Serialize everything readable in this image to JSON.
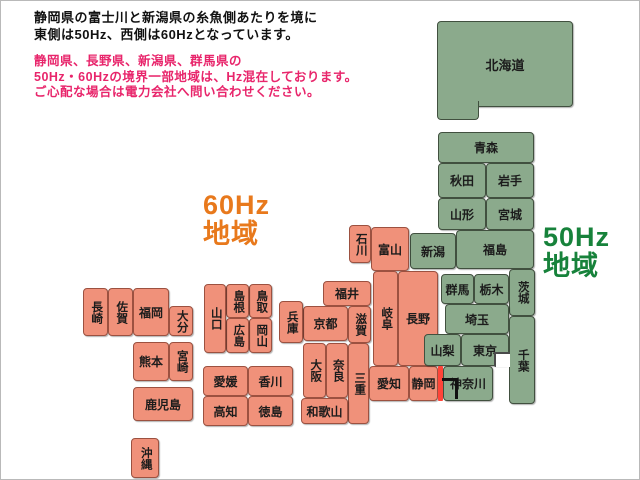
{
  "header": {
    "line1": "静岡県の富士川と新潟県の糸魚側あたりを境に",
    "line2": "東側は50Hz、西側は60Hzとなっています。",
    "text_color": "#111111",
    "notice_line1": "静岡県、長野県、新潟県、群馬県の",
    "notice_line2": "50Hz・60Hzの境界一部地域は、Hz混在しております。",
    "notice_line3": "ご心配な場合は電力会社へ問い合わせください。",
    "notice_color": "#e8256b"
  },
  "legend": {
    "west": {
      "freq": "60Hz",
      "area": "地域",
      "color": "#e8791c"
    },
    "east": {
      "freq": "50Hz",
      "area": "地域",
      "color": "#17823b"
    }
  },
  "map": {
    "colors": {
      "hz50_fill": "#8baa8c",
      "hz50_border": "#41503f",
      "hz60_fill": "#f0917a",
      "hz60_border": "#9c5140",
      "outline": "#4a4a4a",
      "boundary_red": "#ff4438",
      "boundary_black": "#111111"
    },
    "prefectures": [
      {
        "id": "hokkaido",
        "label": "北海道",
        "region": "50",
        "x": 436,
        "y": 20,
        "w": 136,
        "h": 86,
        "orient": "h",
        "cls": "big"
      },
      {
        "id": "hokkaido-leg",
        "label": "",
        "region": "50",
        "x": 436,
        "y": 100,
        "w": 42,
        "h": 19,
        "orient": "h",
        "cls": "noTop"
      },
      {
        "id": "aomori",
        "label": "青森",
        "region": "50",
        "x": 437,
        "y": 131,
        "w": 96,
        "h": 31,
        "orient": "h"
      },
      {
        "id": "akita",
        "label": "秋田",
        "region": "50",
        "x": 437,
        "y": 162,
        "w": 48,
        "h": 35,
        "orient": "h"
      },
      {
        "id": "iwate",
        "label": "岩手",
        "region": "50",
        "x": 485,
        "y": 162,
        "w": 48,
        "h": 35,
        "orient": "h"
      },
      {
        "id": "yamagata",
        "label": "山形",
        "region": "50",
        "x": 437,
        "y": 197,
        "w": 48,
        "h": 32,
        "orient": "h"
      },
      {
        "id": "miyagi",
        "label": "宮城",
        "region": "50",
        "x": 485,
        "y": 197,
        "w": 48,
        "h": 32,
        "orient": "h"
      },
      {
        "id": "niigata",
        "label": "新潟",
        "region": "50",
        "x": 409,
        "y": 232,
        "w": 46,
        "h": 36,
        "orient": "h"
      },
      {
        "id": "fukushima",
        "label": "福島",
        "region": "50",
        "x": 455,
        "y": 229,
        "w": 78,
        "h": 39,
        "orient": "h"
      },
      {
        "id": "ishikawa",
        "label": "石川",
        "region": "60",
        "x": 348,
        "y": 224,
        "w": 22,
        "h": 38,
        "orient": "v"
      },
      {
        "id": "toyama",
        "label": "富山",
        "region": "60",
        "x": 370,
        "y": 226,
        "w": 38,
        "h": 44,
        "orient": "h"
      },
      {
        "id": "gifu",
        "label": "岐阜",
        "region": "60",
        "x": 372,
        "y": 270,
        "w": 25,
        "h": 95,
        "orient": "v"
      },
      {
        "id": "nagano",
        "label": "長野",
        "region": "60",
        "x": 397,
        "y": 270,
        "w": 40,
        "h": 95,
        "orient": "h"
      },
      {
        "id": "fukui",
        "label": "福井",
        "region": "60",
        "x": 322,
        "y": 280,
        "w": 48,
        "h": 25,
        "orient": "h"
      },
      {
        "id": "kyoto",
        "label": "京都",
        "region": "60",
        "x": 302,
        "y": 305,
        "w": 45,
        "h": 35,
        "orient": "h"
      },
      {
        "id": "shiga",
        "label": "滋賀",
        "region": "60",
        "x": 347,
        "y": 305,
        "w": 23,
        "h": 37,
        "orient": "v"
      },
      {
        "id": "hyogo",
        "label": "兵庫",
        "region": "60",
        "x": 278,
        "y": 300,
        "w": 24,
        "h": 42,
        "orient": "v"
      },
      {
        "id": "osaka",
        "label": "大阪",
        "region": "60",
        "x": 302,
        "y": 342,
        "w": 23,
        "h": 55,
        "orient": "v"
      },
      {
        "id": "nara",
        "label": "奈良",
        "region": "60",
        "x": 325,
        "y": 342,
        "w": 22,
        "h": 55,
        "orient": "v"
      },
      {
        "id": "mie",
        "label": "三重",
        "region": "60",
        "x": 347,
        "y": 342,
        "w": 21,
        "h": 81,
        "orient": "v"
      },
      {
        "id": "wakayama",
        "label": "和歌山",
        "region": "60",
        "x": 300,
        "y": 397,
        "w": 47,
        "h": 26,
        "orient": "h"
      },
      {
        "id": "aichi",
        "label": "愛知",
        "region": "60",
        "x": 368,
        "y": 365,
        "w": 40,
        "h": 35,
        "orient": "h"
      },
      {
        "id": "shizuoka",
        "label": "静岡",
        "region": "60",
        "x": 408,
        "y": 365,
        "w": 29,
        "h": 35,
        "orient": "h"
      },
      {
        "id": "tottori",
        "label": "鳥取",
        "region": "60",
        "x": 248,
        "y": 283,
        "w": 23,
        "h": 34,
        "orient": "v"
      },
      {
        "id": "shimane",
        "label": "島根",
        "region": "60",
        "x": 225,
        "y": 283,
        "w": 23,
        "h": 34,
        "orient": "v"
      },
      {
        "id": "okayama",
        "label": "岡山",
        "region": "60",
        "x": 248,
        "y": 317,
        "w": 23,
        "h": 35,
        "orient": "v"
      },
      {
        "id": "hiroshima",
        "label": "広島",
        "region": "60",
        "x": 225,
        "y": 317,
        "w": 23,
        "h": 35,
        "orient": "v"
      },
      {
        "id": "yamaguchi",
        "label": "山口",
        "region": "60",
        "x": 203,
        "y": 283,
        "w": 22,
        "h": 69,
        "orient": "v"
      },
      {
        "id": "ehime",
        "label": "愛媛",
        "region": "60",
        "x": 202,
        "y": 365,
        "w": 45,
        "h": 30,
        "orient": "h"
      },
      {
        "id": "kagawa",
        "label": "香川",
        "region": "60",
        "x": 247,
        "y": 365,
        "w": 45,
        "h": 30,
        "orient": "h"
      },
      {
        "id": "kochi",
        "label": "高知",
        "region": "60",
        "x": 202,
        "y": 395,
        "w": 45,
        "h": 30,
        "orient": "h"
      },
      {
        "id": "tokushima",
        "label": "徳島",
        "region": "60",
        "x": 247,
        "y": 395,
        "w": 45,
        "h": 30,
        "orient": "h"
      },
      {
        "id": "nagasaki",
        "label": "長崎",
        "region": "60",
        "x": 82,
        "y": 287,
        "w": 25,
        "h": 48,
        "orient": "v"
      },
      {
        "id": "saga",
        "label": "佐賀",
        "region": "60",
        "x": 107,
        "y": 287,
        "w": 25,
        "h": 48,
        "orient": "v"
      },
      {
        "id": "fukuoka",
        "label": "福岡",
        "region": "60",
        "x": 132,
        "y": 287,
        "w": 36,
        "h": 48,
        "orient": "h"
      },
      {
        "id": "oita",
        "label": "大分",
        "region": "60",
        "x": 168,
        "y": 305,
        "w": 24,
        "h": 30,
        "orient": "v"
      },
      {
        "id": "kumamoto",
        "label": "熊本",
        "region": "60",
        "x": 132,
        "y": 341,
        "w": 36,
        "h": 39,
        "orient": "h"
      },
      {
        "id": "miyazaki",
        "label": "宮崎",
        "region": "60",
        "x": 168,
        "y": 341,
        "w": 24,
        "h": 39,
        "orient": "v"
      },
      {
        "id": "kagoshima",
        "label": "鹿児島",
        "region": "60",
        "x": 132,
        "y": 386,
        "w": 60,
        "h": 34,
        "orient": "h"
      },
      {
        "id": "okinawa",
        "label": "沖縄",
        "region": "60",
        "x": 130,
        "y": 437,
        "w": 28,
        "h": 40,
        "orient": "v"
      },
      {
        "id": "gunma",
        "label": "群馬",
        "region": "50",
        "x": 440,
        "y": 273,
        "w": 33,
        "h": 30,
        "orient": "h"
      },
      {
        "id": "tochigi",
        "label": "栃木",
        "region": "50",
        "x": 473,
        "y": 273,
        "w": 35,
        "h": 30,
        "orient": "h"
      },
      {
        "id": "ibaraki",
        "label": "茨城",
        "region": "50",
        "x": 508,
        "y": 268,
        "w": 26,
        "h": 47,
        "orient": "v"
      },
      {
        "id": "saitama",
        "label": "埼玉",
        "region": "50",
        "x": 444,
        "y": 303,
        "w": 64,
        "h": 30,
        "orient": "h"
      },
      {
        "id": "yamanashi",
        "label": "山梨",
        "region": "50",
        "x": 423,
        "y": 333,
        "w": 37,
        "h": 32,
        "orient": "h"
      },
      {
        "id": "tokyo",
        "label": "東京",
        "region": "50",
        "x": 460,
        "y": 333,
        "w": 48,
        "h": 32,
        "orient": "h"
      },
      {
        "id": "chiba",
        "label": "千葉",
        "region": "50",
        "x": 508,
        "y": 315,
        "w": 26,
        "h": 88,
        "orient": "v"
      },
      {
        "id": "kanagawa",
        "label": "神奈川",
        "region": "50",
        "x": 442,
        "y": 365,
        "w": 50,
        "h": 35,
        "orient": "h"
      }
    ],
    "features": [
      {
        "id": "tokyo-bay-notch",
        "cls": "bay",
        "x": 493,
        "y": 351,
        "w": 16,
        "h": 15
      },
      {
        "id": "hz-boundary-red-line",
        "cls": "redline",
        "x": 437,
        "y": 365,
        "w": 5,
        "h": 35
      },
      {
        "id": "fujikawa-boundary-line",
        "cls": "fujiline",
        "x": 441,
        "y": 377,
        "w": 16,
        "h": 21
      }
    ]
  }
}
